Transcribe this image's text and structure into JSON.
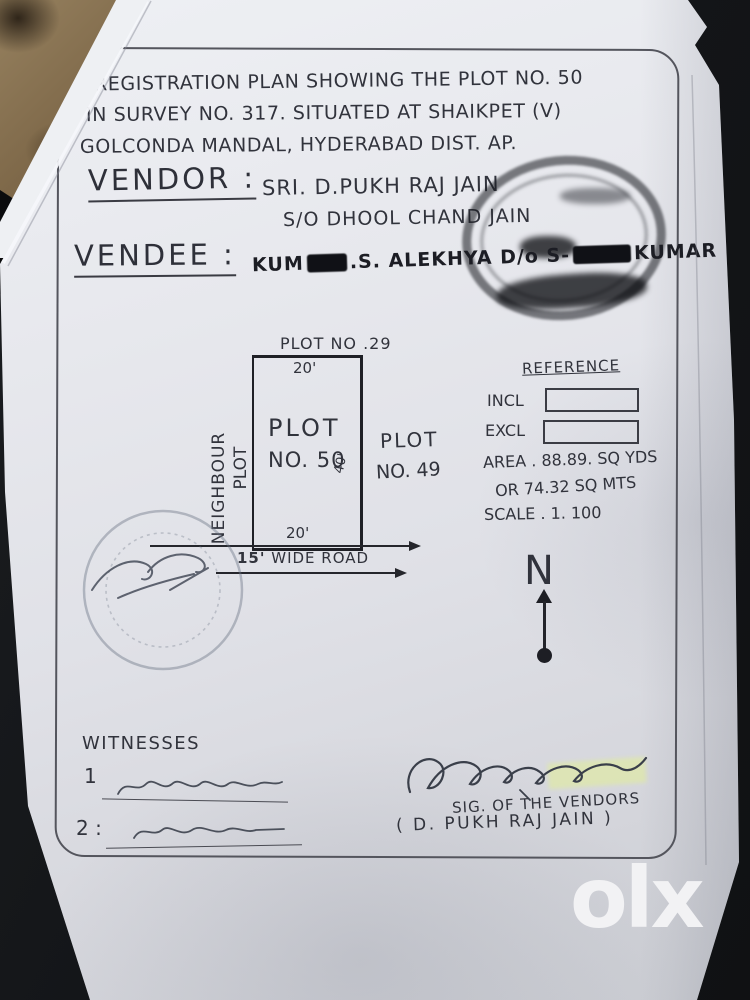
{
  "doc": {
    "title": {
      "l1": "REGISTRATION PLAN SHOWING THE PLOT NO. 50",
      "l2": "IN SURVEY NO. 317.  SITUATED AT SHAIKPET (V)",
      "l3": "GOLCONDA MANDAL,  HYDERABAD DIST.   AP."
    },
    "vendor": {
      "label": "VENDOR :",
      "name": "SRI. D.PUKH RAJ JAIN",
      "father": "S/O DHOOL CHAND JAIN"
    },
    "vendee": {
      "label": "VENDEE :",
      "name_p1": "KUM",
      "name_p2": ".S. ALEKHYA  D/o  S-",
      "name_p3": "KUMAR"
    },
    "plot": {
      "north_plot": "PLOT NO .29",
      "top_dim": "20'",
      "name_l1": "PLOT",
      "name_l2": "NO. 50",
      "side_dim": "40'",
      "east_plot_l1": "PLOT",
      "east_plot_l2": "NO. 49",
      "west_label_l1": "NEIGHBOUR",
      "west_label_l2": "PLOT",
      "bottom_dim": "20'",
      "road_dim": "15'",
      "road_text": " WIDE ROAD"
    },
    "reference": {
      "title": "REFERENCE",
      "incl": "INCL",
      "excl": "EXCL",
      "area_l1": "AREA . 88.89. SQ YDS",
      "area_l2": "OR   74.32 SQ MTS",
      "scale": "SCALE . 1. 100"
    },
    "compass": {
      "north": "N"
    },
    "witnesses": {
      "title": "WITNESSES",
      "no1": "1",
      "no2": "2 :"
    },
    "signature": {
      "caption_l1": "SIG. OF THE VENDORS",
      "caption_l2": "( D. PUKH RAJ JAIN )"
    }
  },
  "watermark": {
    "logo": "olx"
  },
  "colors": {
    "ink": "#31333c",
    "paper": "#e6e7ec",
    "redaction": "#101116",
    "highlight": "#e1ee96"
  }
}
